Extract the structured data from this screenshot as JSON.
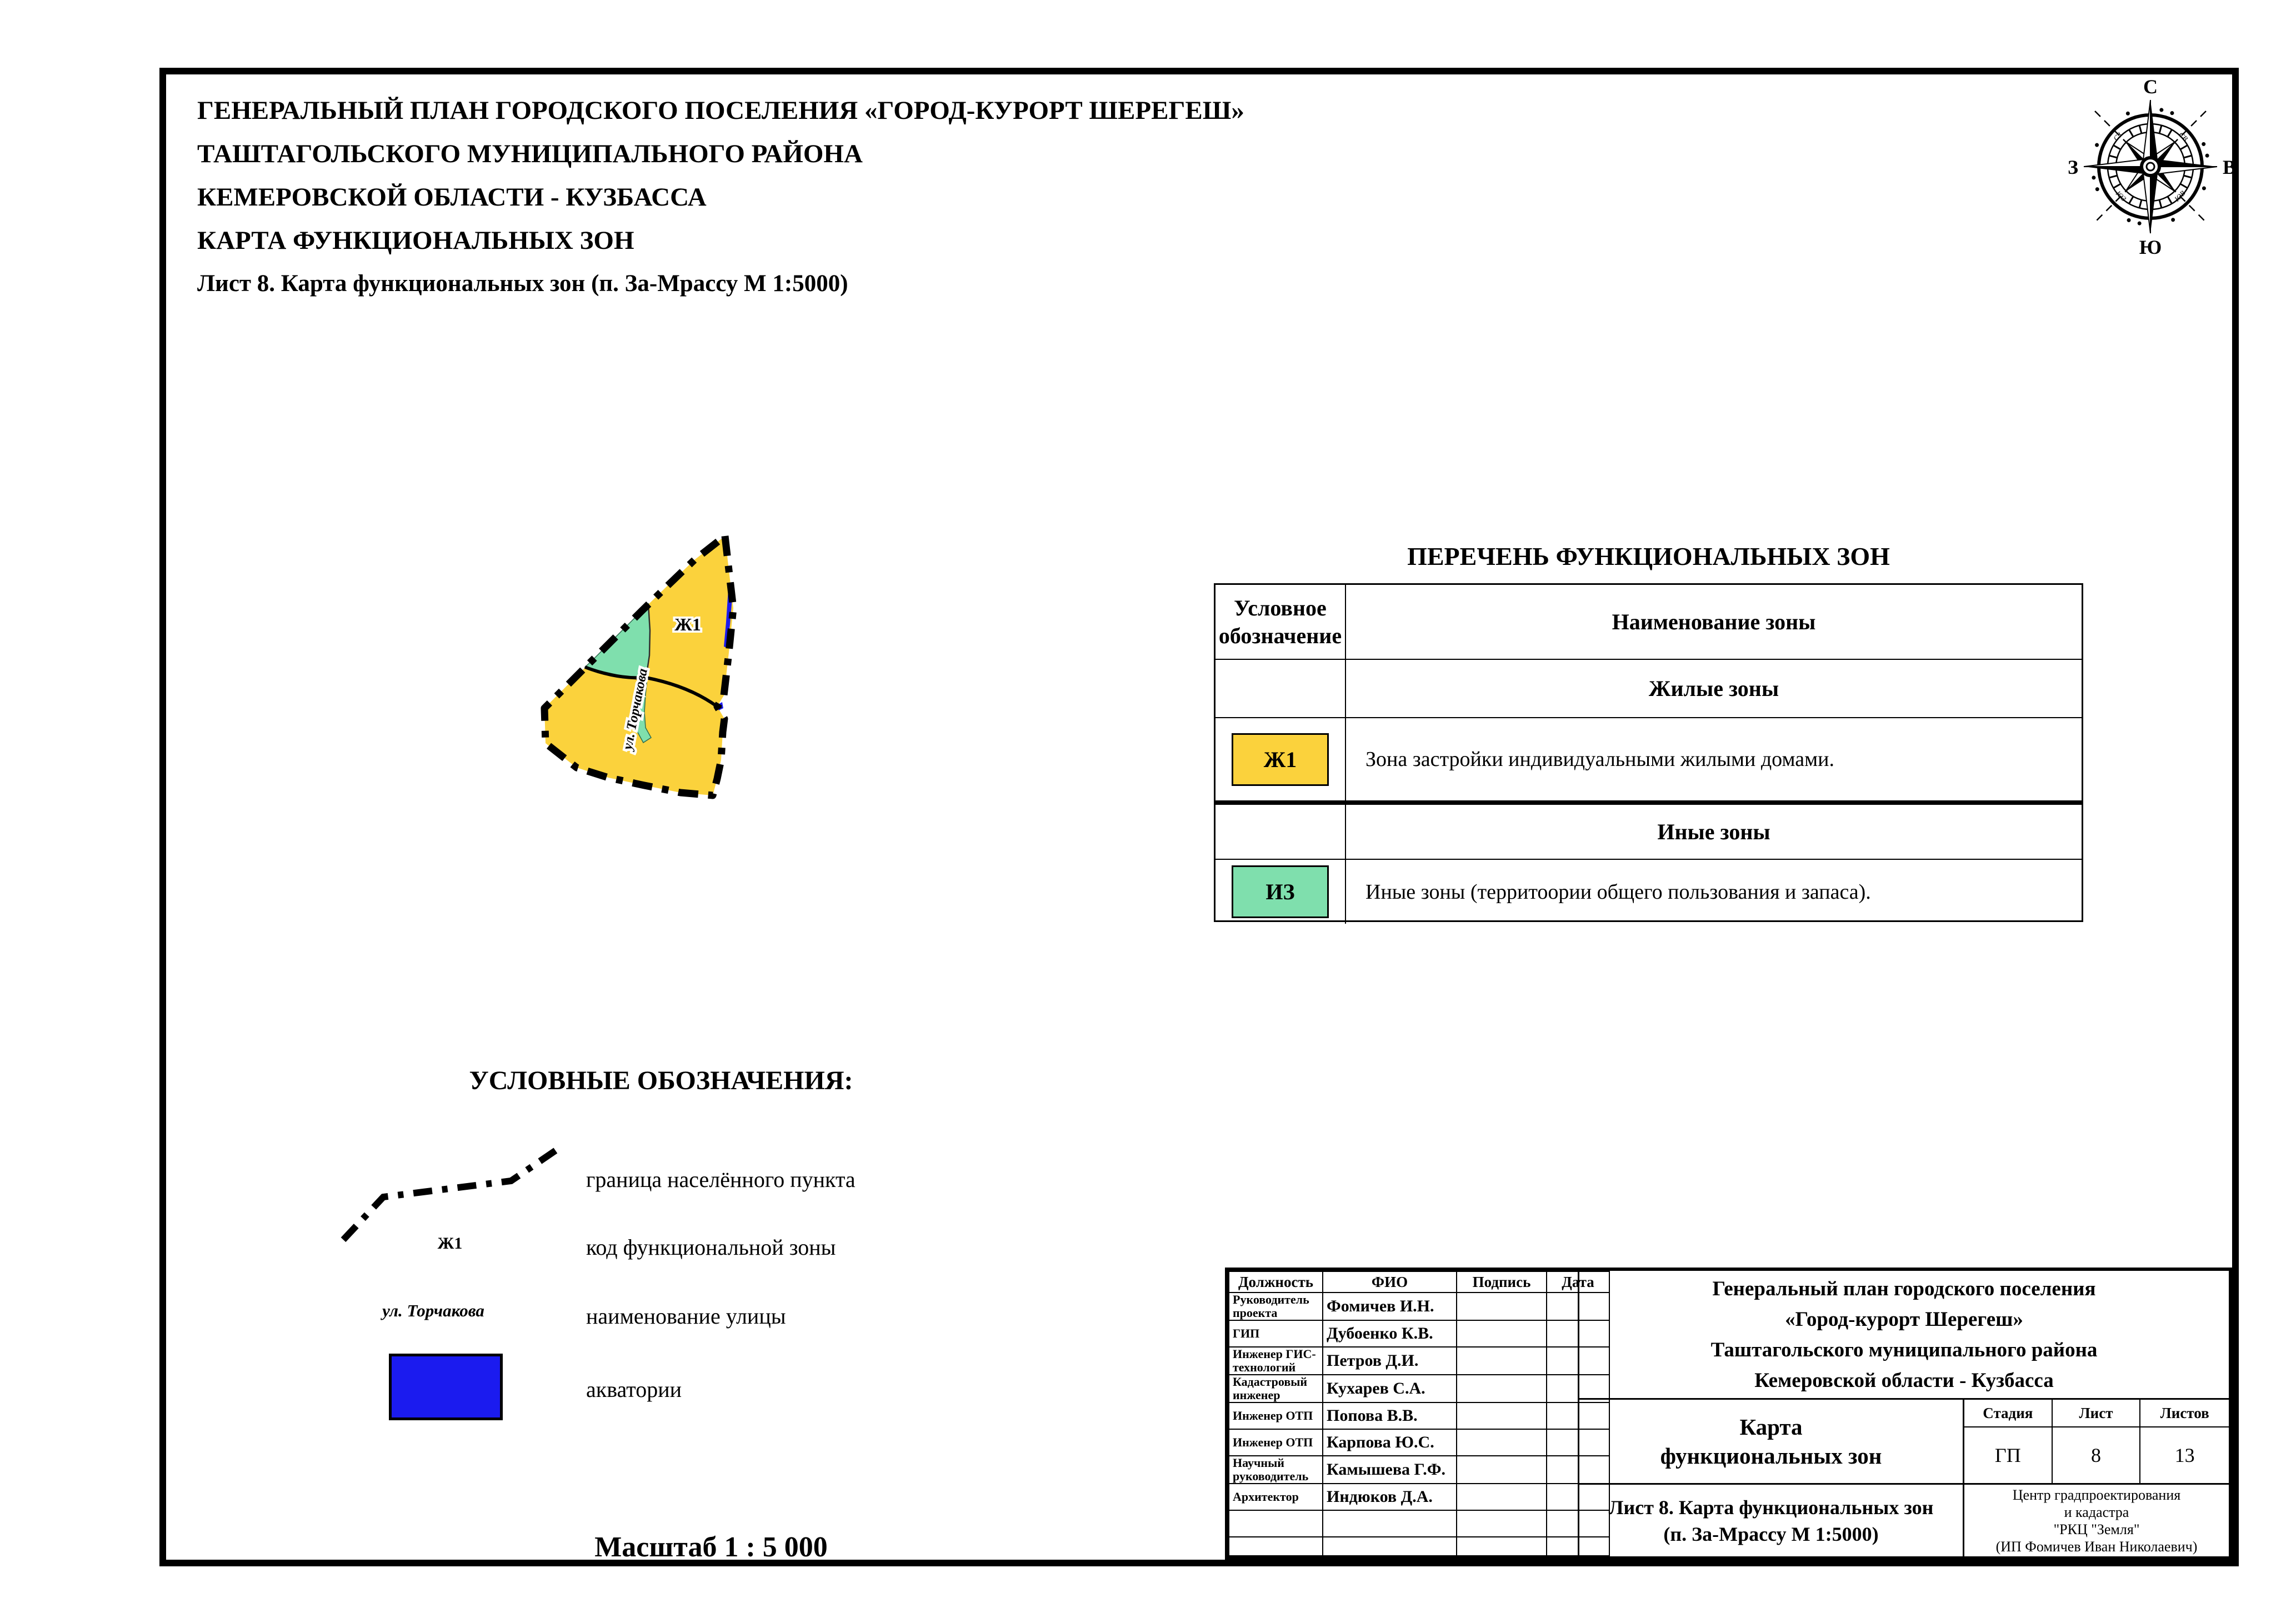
{
  "page": {
    "title_lines": [
      "ГЕНЕРАЛЬНЫЙ ПЛАН ГОРОДСКОГО ПОСЕЛЕНИЯ «ГОРОД-КУРОРТ ШЕРЕГЕШ»",
      "ТАШТАГОЛЬСКОГО МУНИЦИПАЛЬНОГО РАЙОНА",
      "КЕМЕРОВСКОЙ ОБЛАСТИ - КУЗБАССА",
      "КАРТА ФУНКЦИОНАЛЬНЫХ ЗОН",
      "Лист 8. Карта функциональных зон (п. За-Мрассу М 1:5000)"
    ],
    "scale_note": "Масштаб 1 : 5 000"
  },
  "compass": {
    "north": "С",
    "south": "Ю",
    "east": "В",
    "west": "З",
    "ne": "СВ",
    "nw": "СЗ",
    "se": "ЮВ",
    "sw": "ЮЗ"
  },
  "map": {
    "zone_code_label": "Ж1",
    "street_label": "ул. Торчакова",
    "colors": {
      "residential": "#FBD23C",
      "other_zones": "#7FDFAD",
      "water": "#1B1BEF",
      "boundary": "#000000"
    }
  },
  "zones_table": {
    "title": "ПЕРЕЧЕНЬ ФУНКЦИОНАЛЬНЫХ ЗОН",
    "col1_header": "Условное обозначение",
    "col2_header": "Наименование зоны",
    "group1": "Жилые зоны",
    "row1_code": "Ж1",
    "row1_desc": "Зона застройки индивидуальными жилыми домами.",
    "group2": "Иные зоны",
    "row2_code": "ИЗ",
    "row2_desc": "Иные зоны (территоории общего пользования и запаса)."
  },
  "legend": {
    "title": "УСЛОВНЫЕ ОБОЗНАЧЕНИЯ:",
    "item1_label": "граница населённого пункта",
    "item2_symbol": "Ж1",
    "item2_label": "код функциональной зоны",
    "item3_symbol": "ул. Торчакова",
    "item3_label": "наименование улицы",
    "item4_label": "акватории"
  },
  "stamp": {
    "staff_headers": [
      "Должность",
      "ФИО",
      "Подпись",
      "Дата"
    ],
    "staff_rows": [
      {
        "role": "Руководитель проекта",
        "name": "Фомичев И.Н."
      },
      {
        "role": "ГИП",
        "name": "Дубоенко К.В."
      },
      {
        "role": "Инженер ГИС-технологий",
        "name": "Петров Д.И."
      },
      {
        "role": "Кадастровый инженер",
        "name": "Кухарев С.А."
      },
      {
        "role": "Инженер ОТП",
        "name": "Попова В.В."
      },
      {
        "role": "Инженер ОТП",
        "name": "Карпова Ю.С."
      },
      {
        "role": "Научный руководитель",
        "name": "Камышева Г.Ф."
      },
      {
        "role": "Архитектор",
        "name": "Индюков Д.А."
      },
      {
        "role": "",
        "name": ""
      },
      {
        "role": "",
        "name": ""
      }
    ],
    "project_title_lines": [
      "Генеральный план городского поселения",
      "«Город-курорт Шерегеш»",
      "Таштагольского муниципального района",
      "Кемеровской области - Кузбасса"
    ],
    "doc_title_lines": [
      "Карта",
      "функциональных зон"
    ],
    "stage_header": "Стадия",
    "sheet_header": "Лист",
    "sheets_header": "Листов",
    "stage": "ГП",
    "sheet": "8",
    "sheets": "13",
    "sheet_caption_lines": [
      "Лист 8. Карта функциональных зон",
      "(п. За-Мрассу М 1:5000)"
    ],
    "org_lines": [
      "Центр градпроектирования",
      "и кадастра",
      "\"РКЦ \"Земля\"",
      "(ИП Фомичев Иван Николаевич)"
    ]
  }
}
